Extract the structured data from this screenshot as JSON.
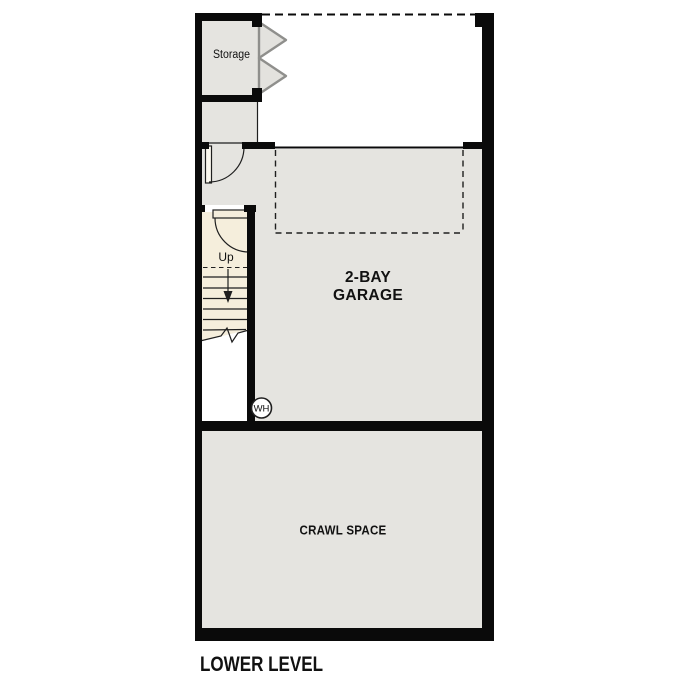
{
  "plan_title": "LOWER LEVEL",
  "rooms": {
    "storage": {
      "label": "Storage"
    },
    "garage": {
      "label_line1": "2-BAY",
      "label_line2": "GARAGE"
    },
    "crawl_space": {
      "label": "CRAWL SPACE"
    },
    "stairs": {
      "up_label": "Up"
    },
    "water_heater": {
      "abbr": "WH"
    }
  },
  "colors": {
    "background": "#ffffff",
    "wall": "#0a0a0a",
    "room-fill": "#e5e4e0",
    "stair-fill": "#f5eedc",
    "door-leaf": "#fcf9f0",
    "double-door-fill": "#e3e2de",
    "double-door-stroke": "#8f8f8c",
    "line": "#1f1f1f",
    "text": "#111111"
  }
}
